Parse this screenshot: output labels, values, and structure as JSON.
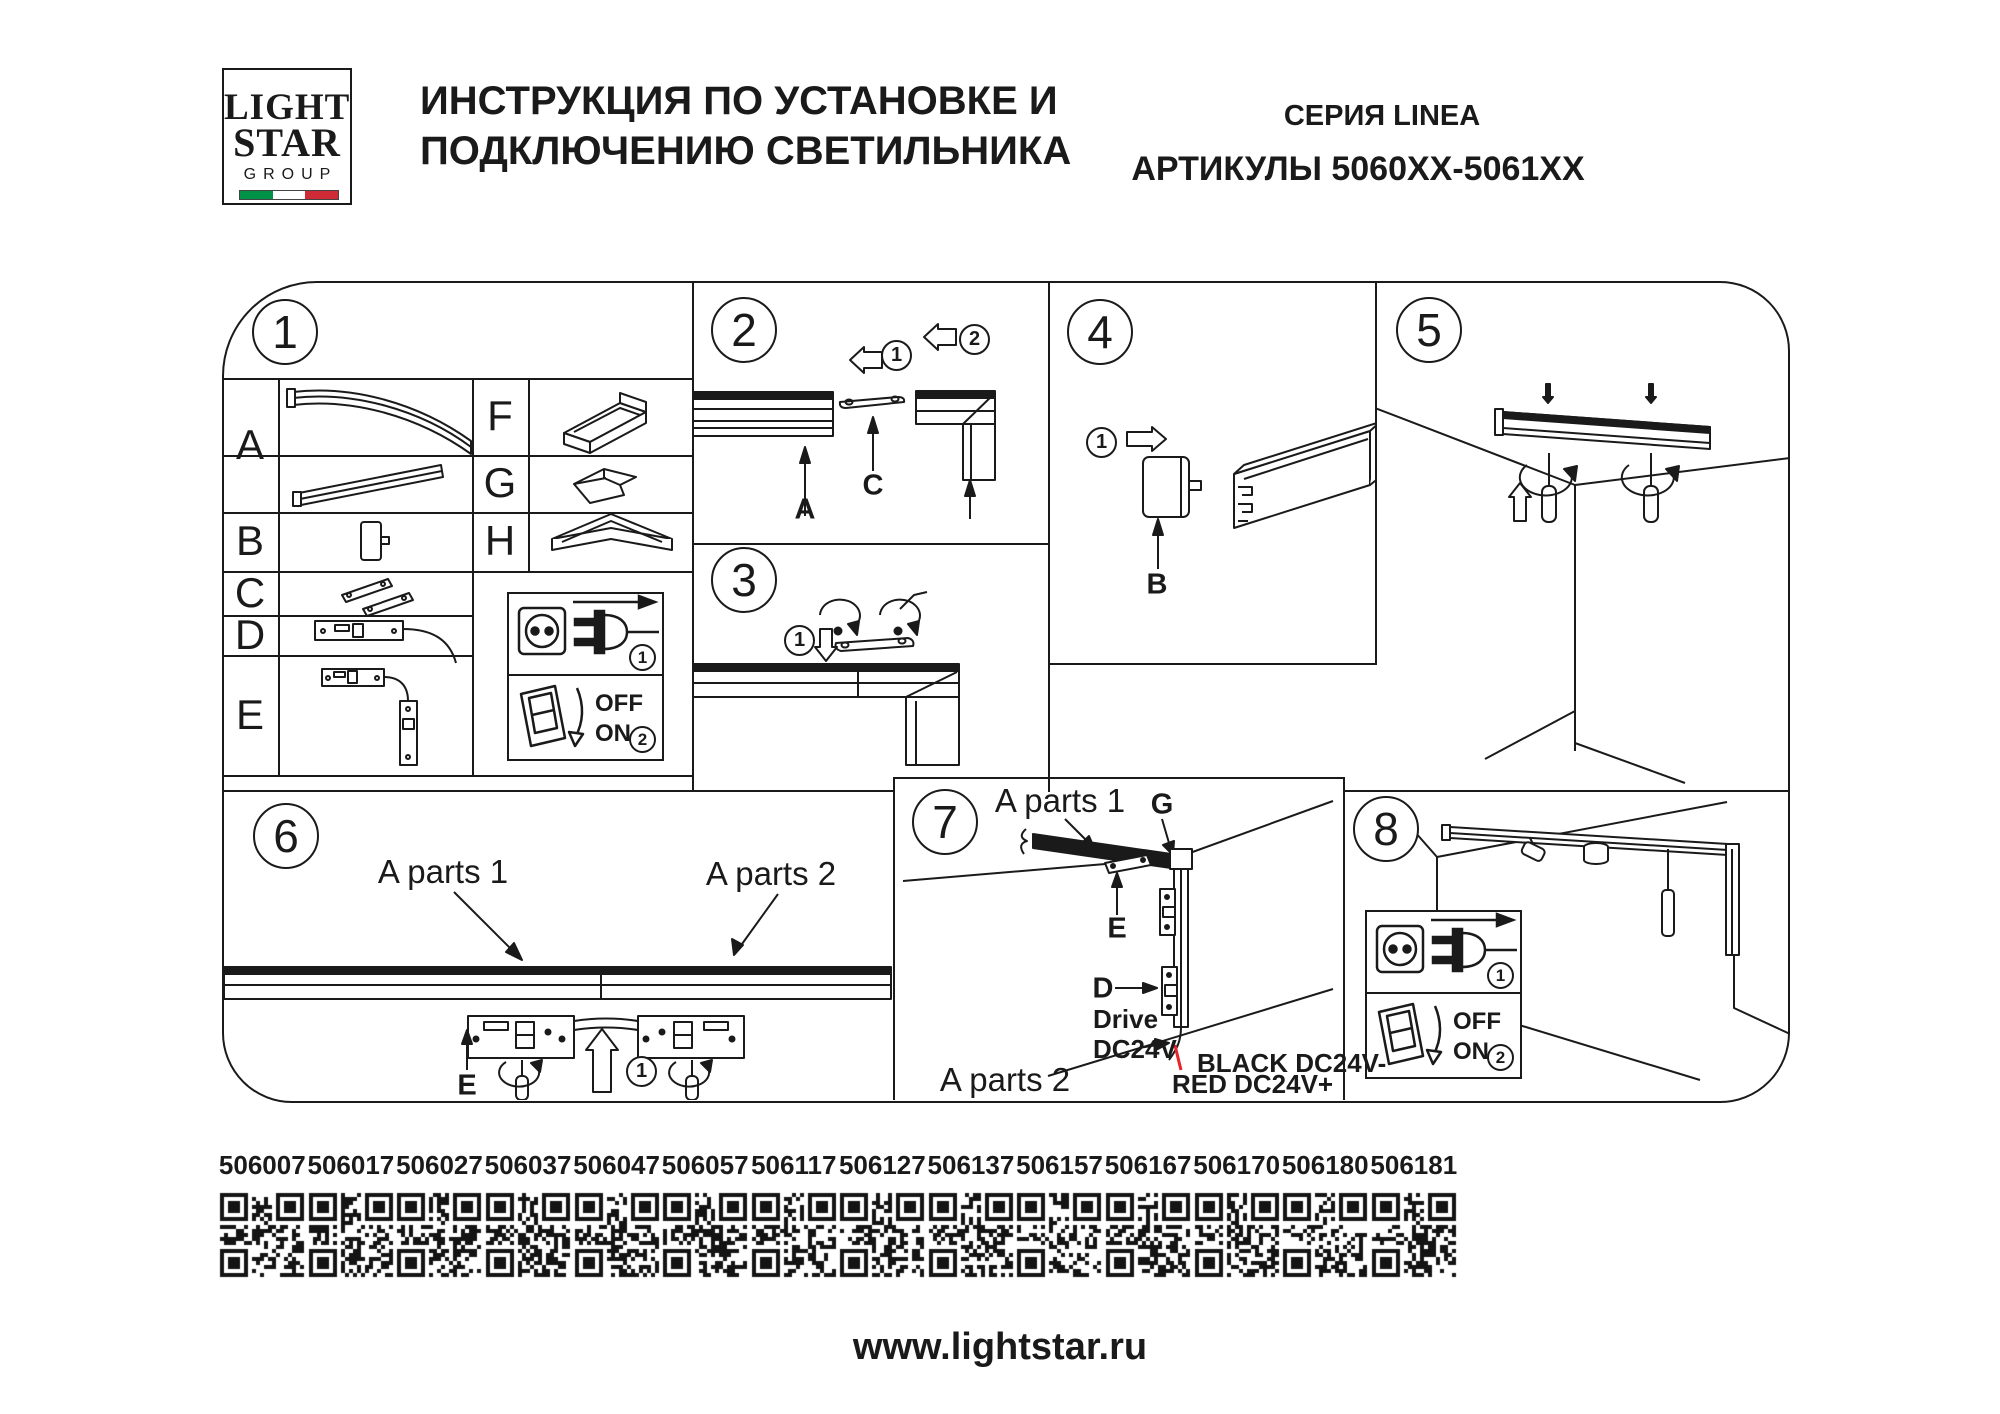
{
  "header": {
    "logo": {
      "word1": "LIGHT",
      "word2": "STAR",
      "word3": "GROUP"
    },
    "title_line1": "ИНСТРУКЦИЯ ПО УСТАНОВКЕ И",
    "title_line2": "ПОДКЛЮЧЕНИЮ СВЕТИЛЬНИКА",
    "series": "СЕРИЯ LINEA",
    "articles": "АРТИКУЛЫ 5060XX-5061XX"
  },
  "sections": {
    "s1": {
      "number": "1",
      "parts": {
        "a": "A",
        "b": "B",
        "c": "C",
        "d": "D",
        "e": "E",
        "f": "F",
        "g": "G",
        "h": "H"
      }
    },
    "s2": {
      "number": "2",
      "step1": "1",
      "step2": "2",
      "label_a": "A",
      "label_c": "C"
    },
    "s3": {
      "number": "3",
      "step1": "1"
    },
    "s4": {
      "number": "4",
      "step1": "1",
      "label_b": "B"
    },
    "s5": {
      "number": "5"
    },
    "s6": {
      "number": "6",
      "a_parts_1": "A parts 1",
      "a_parts_2": "A parts 2",
      "label_e": "E",
      "step1": "1"
    },
    "s7": {
      "number": "7",
      "a_parts_1": "A parts 1",
      "a_parts_2": "A parts 2",
      "label_g": "G",
      "label_e": "E",
      "label_d": "D",
      "drive_line1": "Drive",
      "drive_line2": "DC24V",
      "wire_black_label": "BLACK DC24V-",
      "wire_red_label": "RED DC24V+"
    },
    "s8": {
      "number": "8"
    }
  },
  "plugbox": {
    "step_plug": "1",
    "step_switch": "2",
    "off": "OFF",
    "on": "ON"
  },
  "qr_codes": [
    "506007",
    "506017",
    "506027",
    "506037",
    "506047",
    "506057",
    "506117",
    "506127",
    "506137",
    "506157",
    "506167",
    "506170",
    "506180",
    "506181"
  ],
  "footer": {
    "url": "www.lightstar.ru"
  },
  "colors": {
    "ink": "#1a1a1a",
    "wire_red": "#e8232a",
    "flag_green": "#009246",
    "flag_white": "#ffffff",
    "flag_red": "#ce2b37"
  }
}
